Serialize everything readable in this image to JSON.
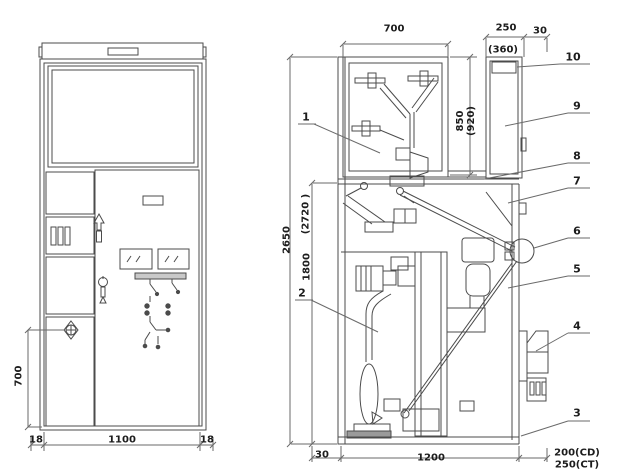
{
  "drawing": {
    "background": "#ffffff",
    "line_color": "#4b4b4b",
    "text_color": "#1c1c1c"
  },
  "front_view": {
    "dim_handle_height": "700",
    "dim_frame_left": "18",
    "dim_width": "1100",
    "dim_frame_right": "18"
  },
  "side_view": {
    "dim_busbar_depth": "700",
    "dim_rear_duct_depth": "250",
    "dim_rear_offset": "30",
    "dim_rear_duct_depth_alt": "(360)",
    "dim_upper_height": "850",
    "dim_upper_height_alt": "(920)",
    "dim_total_height": "2650",
    "dim_total_height_alt": "(2720 )",
    "dim_lower_height": "1800",
    "dim_front_offset": "30",
    "dim_depth": "1200",
    "dim_rear_ext_cd": "200(CD)",
    "dim_rear_ext_ct": "250(CT)",
    "callouts": [
      {
        "label": "1"
      },
      {
        "label": "2"
      },
      {
        "label": "3"
      },
      {
        "label": "4"
      },
      {
        "label": "5"
      },
      {
        "label": "6"
      },
      {
        "label": "7"
      },
      {
        "label": "8"
      },
      {
        "label": "9"
      },
      {
        "label": "10"
      }
    ]
  }
}
